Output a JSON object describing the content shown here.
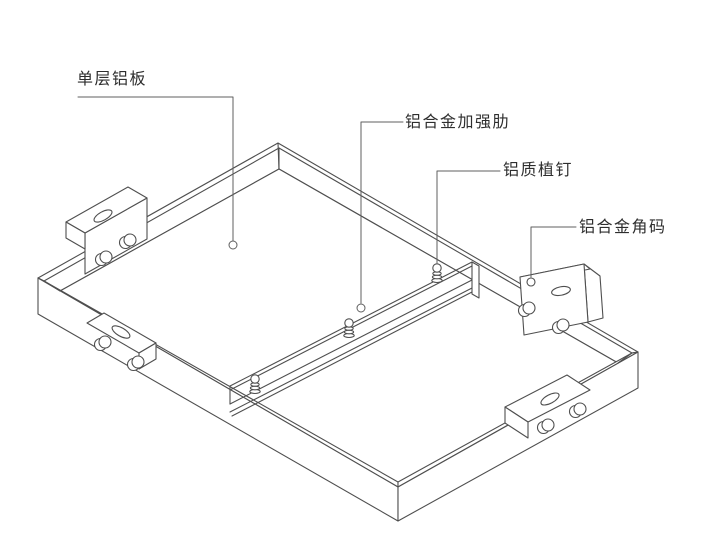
{
  "diagram": {
    "type": "isometric-assembly-line-drawing",
    "background": "#ffffff",
    "line_color": "#4f4f4f",
    "leader_color": "#5f5f5f",
    "text_color": "#2e2e2e"
  },
  "labels": {
    "panel": "单层铝板",
    "rib": "铝合金加强肋",
    "stud": "铝质植钉",
    "bracket": "铝合金角码"
  }
}
